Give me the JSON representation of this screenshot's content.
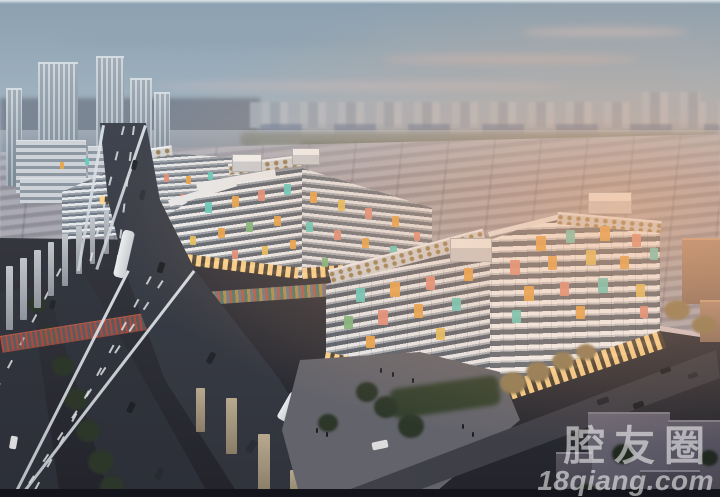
{
  "watermark": {
    "brand": "腔友圈",
    "site": "18qiang.com"
  },
  "palette": {
    "sky_top": "#8ba0b0",
    "sunset_glow": "#eba878",
    "building_white": "#f2f3f4",
    "panel_orange": "#e9a54c",
    "panel_coral": "#e18f7b",
    "panel_teal": "#63ccc1",
    "panel_yellow": "#e5c15f",
    "panel_green": "#7cb87e",
    "asphalt": "#3a3e48",
    "warehouse_gray": "#9a9aa5",
    "watermark_color": "rgba(255,255,255,0.55)"
  }
}
